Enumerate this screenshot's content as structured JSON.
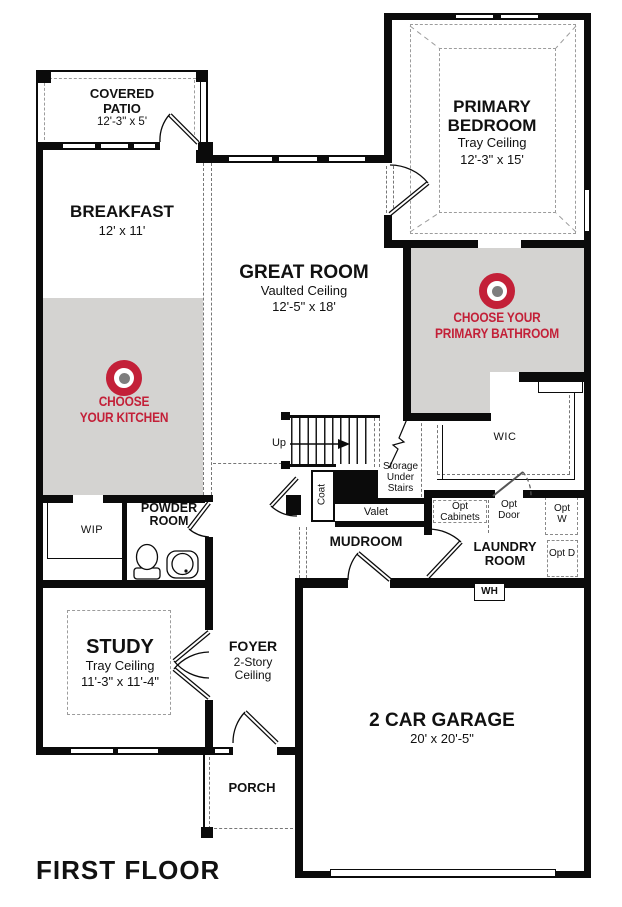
{
  "title": "FIRST FLOOR",
  "colors": {
    "accent_red": "#c32038",
    "highlight_gray": "#d4d3d1",
    "wall_black": "#0b0b0b"
  },
  "rooms": {
    "covered_patio": {
      "name": "COVERED PATIO",
      "dims": "12'-3\" x 5'"
    },
    "breakfast": {
      "name": "BREAKFAST",
      "dims": "12' x 11'"
    },
    "great_room": {
      "name": "GREAT ROOM",
      "ceiling": "Vaulted Ceiling",
      "dims": "12'-5\" x 18'"
    },
    "primary_bedroom": {
      "name": "PRIMARY BEDROOM",
      "ceiling": "Tray Ceiling",
      "dims": "12'-3\" x 15'"
    },
    "study": {
      "name": "STUDY",
      "ceiling": "Tray Ceiling",
      "dims": "11'-3\" x 11'-4\""
    },
    "foyer": {
      "name": "FOYER",
      "ceiling": "2-Story Ceiling"
    },
    "porch": {
      "name": "PORCH"
    },
    "garage": {
      "name": "2 CAR GARAGE",
      "dims": "20' x 20'-5\""
    },
    "mudroom": {
      "name": "MUDROOM"
    },
    "laundry_room": {
      "name": "LAUNDRY ROOM"
    },
    "powder_room": {
      "name": "POWDER ROOM"
    },
    "wip": {
      "name": "WIP"
    },
    "wic": {
      "name": "WIC"
    }
  },
  "annotations": {
    "up": "Up",
    "storage": "Storage Under Stairs",
    "coat": "Coat",
    "valet": "Valet",
    "water_heater": "WH",
    "opt_cabinets": "Opt Cabinets",
    "opt_door": "Opt Door",
    "opt_washer": "Opt W",
    "opt_dryer": "Opt D"
  },
  "choices": {
    "kitchen": {
      "line1": "CHOOSE",
      "line2": "YOUR KITCHEN"
    },
    "primary_bathroom": {
      "line1": "CHOOSE YOUR",
      "line2": "PRIMARY BATHROOM"
    }
  }
}
